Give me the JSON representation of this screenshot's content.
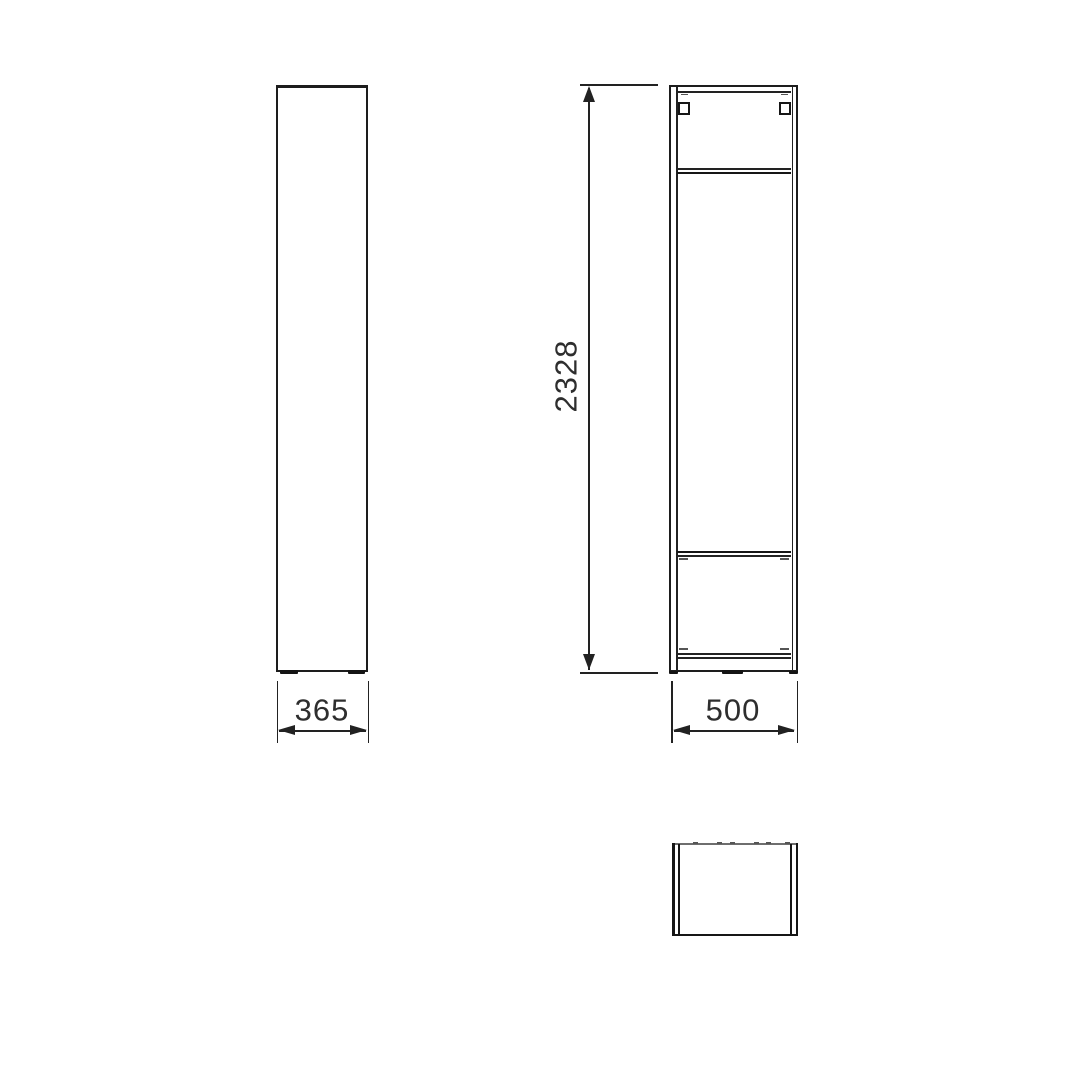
{
  "drawing": {
    "type": "furniture-technical-drawing",
    "colors": {
      "background": "#ffffff",
      "line": "#1d1d1d",
      "gray_line": "#6e6e6e",
      "text": "#2e2e2e"
    },
    "dimensions": {
      "overall_height": "2328",
      "front_width": "500",
      "side_depth": "365"
    },
    "views": [
      {
        "name": "side-elevation"
      },
      {
        "name": "front-elevation"
      },
      {
        "name": "plan-view"
      }
    ]
  }
}
